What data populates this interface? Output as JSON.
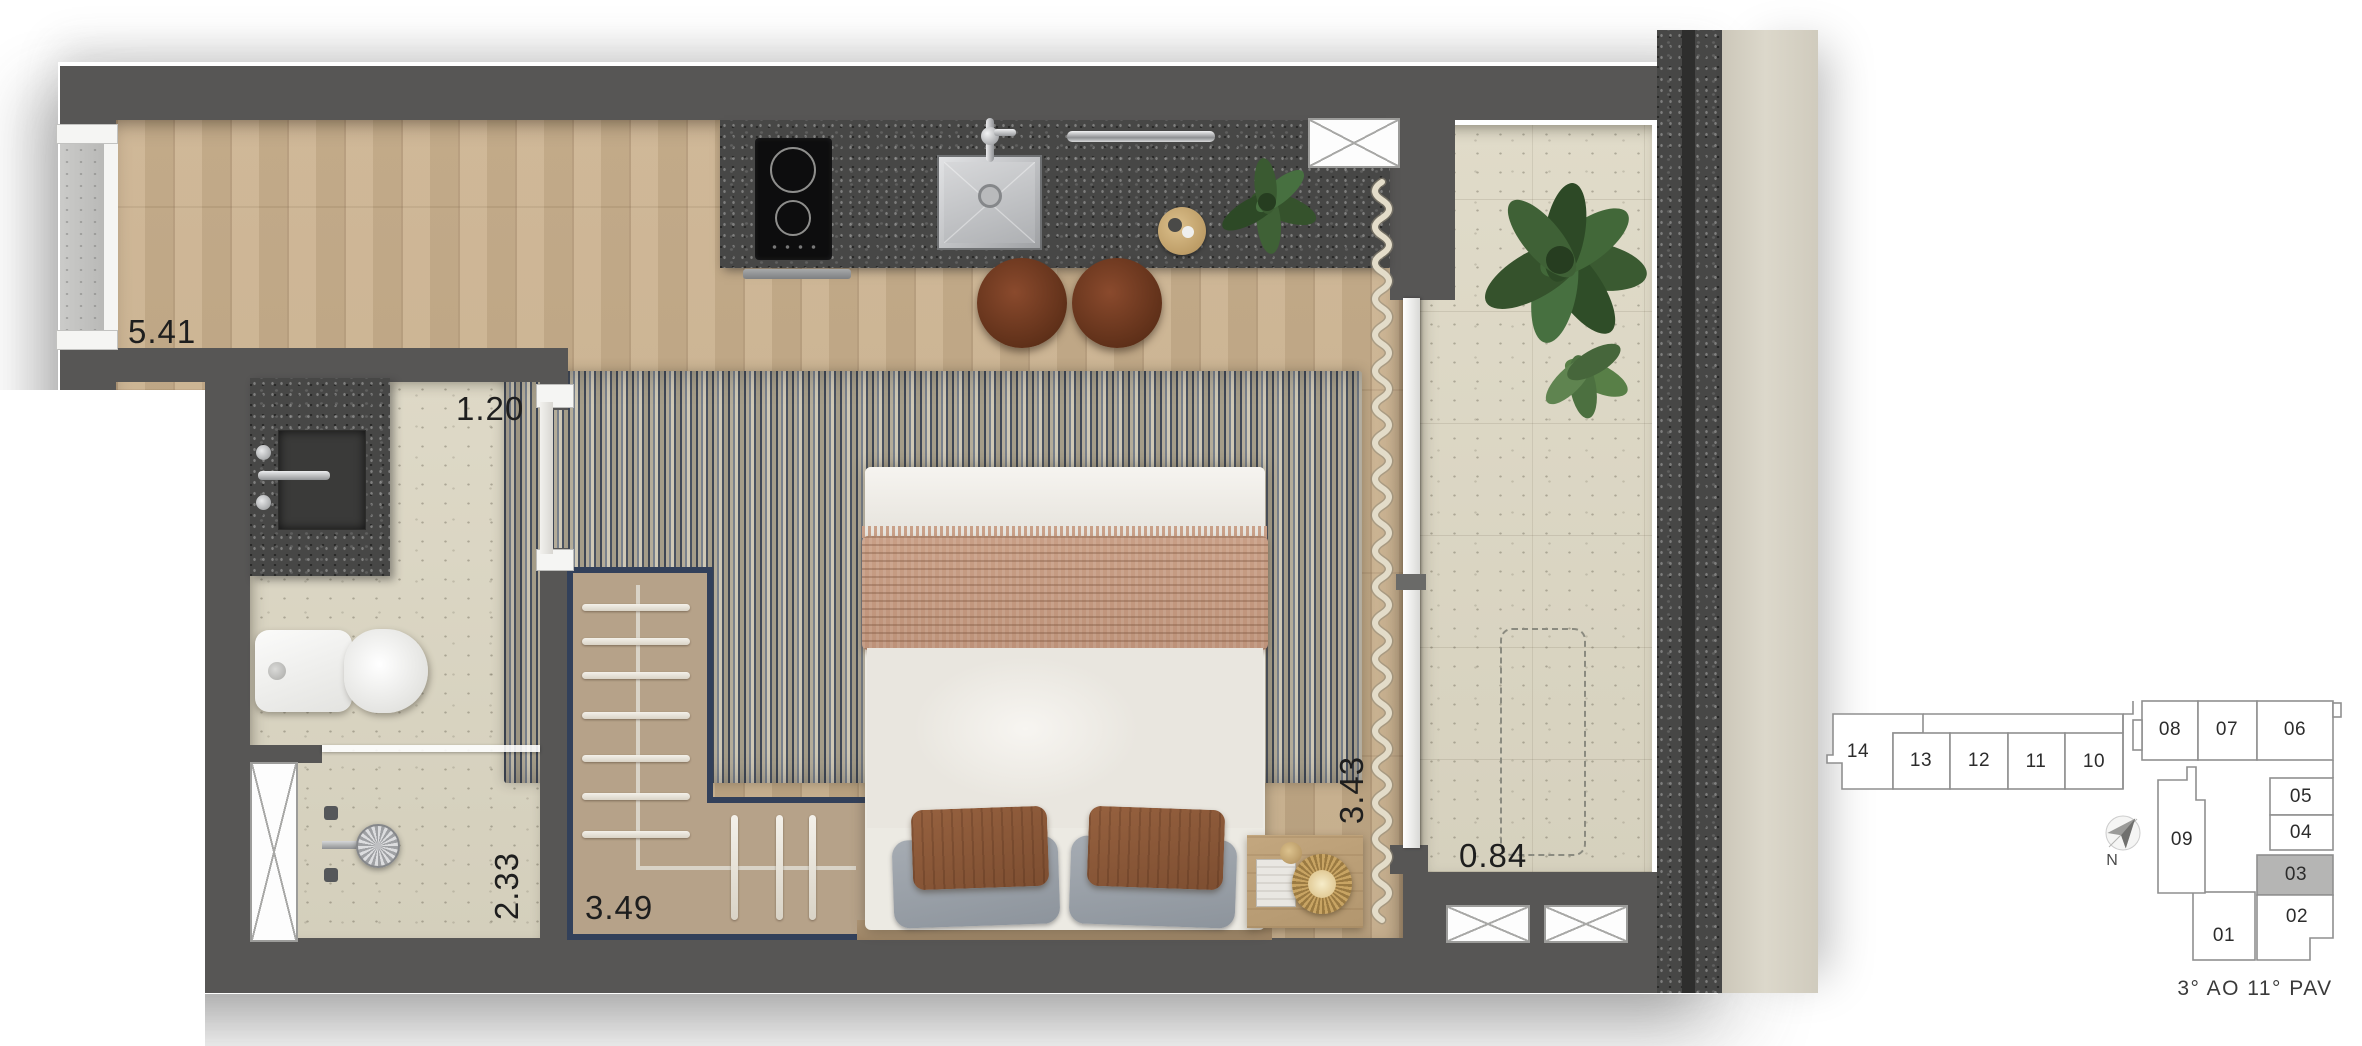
{
  "floor_plan": {
    "dimensions": [
      {
        "room": "living",
        "value": "5.41"
      },
      {
        "room": "hall",
        "value": "1.20"
      },
      {
        "room": "bathroom",
        "value": "2.33"
      },
      {
        "room": "closet",
        "value": "3.49"
      },
      {
        "room": "bedroom",
        "value": "3.43"
      },
      {
        "room": "balcony",
        "value": "0.84"
      }
    ]
  },
  "key_plan": {
    "units": [
      {
        "number": "14"
      },
      {
        "number": "13"
      },
      {
        "number": "12"
      },
      {
        "number": "11"
      },
      {
        "number": "10"
      },
      {
        "number": "08"
      },
      {
        "number": "07"
      },
      {
        "number": "06"
      },
      {
        "number": "09"
      },
      {
        "number": "05"
      },
      {
        "number": "04"
      },
      {
        "number": "03",
        "highlighted": true
      },
      {
        "number": "02"
      },
      {
        "number": "01"
      }
    ],
    "highlighted_unit": "03",
    "caption": "3° AO 11° PAV",
    "north_label": "N"
  },
  "colors": {
    "wall": "#575655",
    "wood_floor": "#c7ae8b",
    "tile_floor": "#dad5c3",
    "granite": "#474746",
    "rug_navy": "#3e4654",
    "closet_fill": "#b6a289",
    "closet_border": "#32405a",
    "keyplan_highlight": "#b5b5b4",
    "plant_green": "#3f6136"
  }
}
